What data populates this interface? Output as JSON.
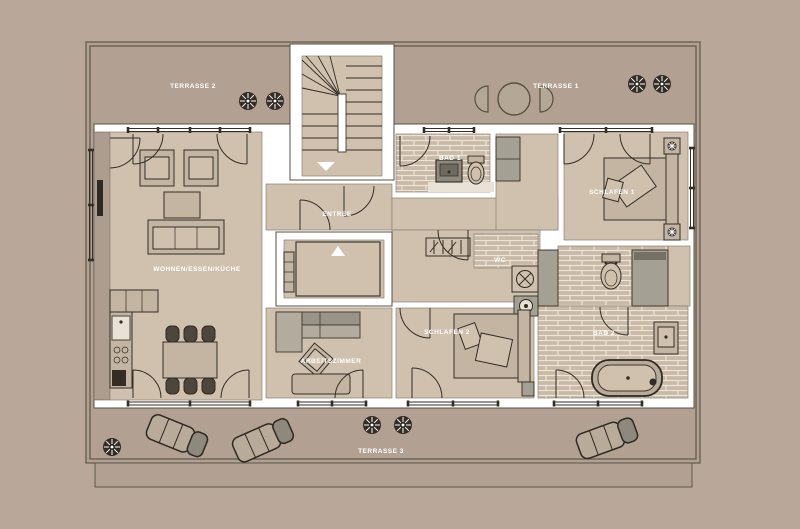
{
  "labels": {
    "terrasse2": "TERRASSE 2",
    "terrasse1": "TERRASSE 1",
    "terrasse3": "TERRASSE 3",
    "wohnen": "WOHNEN/ESSEN/KÜCHE",
    "entree": "ENTREE",
    "bad1": "BAD 1",
    "schlafen1": "SCHLAFEN 1",
    "wc": "WC",
    "schlafen2": "SCHLAFEN 2",
    "arbeitszimmer": "ARBEITSZIMMER",
    "bad2": "BAD 2"
  },
  "colors": {
    "background": "#b9a899",
    "terrace": "#b2a193",
    "floor": "#cfc1ae",
    "wall": "#ffffff",
    "outline": "#57503f",
    "furniture": "#c3b5a2",
    "furniture_gray": "#a5a094",
    "tile": "#c9baa7",
    "dark": "#332d26",
    "label_text": "#ffffff"
  }
}
